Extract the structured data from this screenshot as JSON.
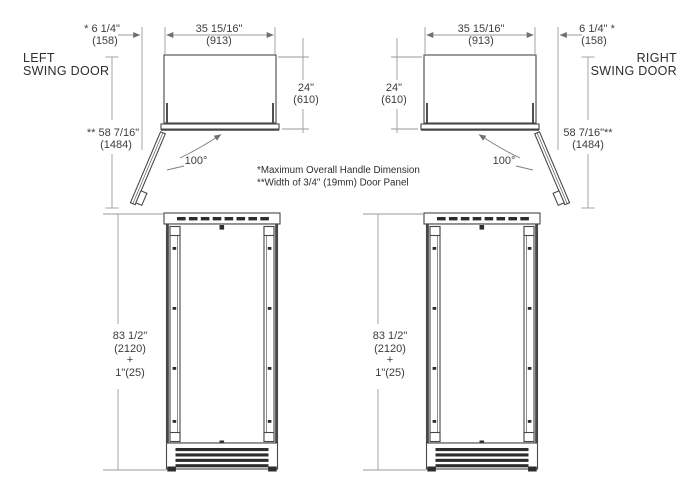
{
  "labels": {
    "left_door": [
      "LEFT",
      "SWING DOOR"
    ],
    "right_door": [
      "RIGHT",
      "SWING DOOR"
    ]
  },
  "notes": [
    "*Maximum Overall Handle Dimension",
    "**Width of 3/4\" (19mm) Door Panel"
  ],
  "left": {
    "handle_clearance_in": "* 6 1/4\"",
    "handle_clearance_mm": "(158)",
    "width_in": "35 15/16\"",
    "width_mm": "(913)",
    "depth_in": "24\"",
    "depth_mm": "(610)",
    "open_depth_in": "** 58 7/16\"",
    "open_depth_mm": "(1484)",
    "swing_angle": "100°",
    "height_in": "83 1/2\"",
    "height_mm": "(2120)",
    "height_plus": "+",
    "height_extra": "1\"(25)"
  },
  "right": {
    "handle_clearance_in": "6 1/4\" *",
    "handle_clearance_mm": "(158)",
    "width_in": "35 15/16\"",
    "width_mm": "(913)",
    "depth_in": "24\"",
    "depth_mm": "(610)",
    "open_depth_in": "58 7/16\"**",
    "open_depth_mm": "(1484)",
    "swing_angle": "100°",
    "height_in": "83 1/2\"",
    "height_mm": "(2120)",
    "height_plus": "+",
    "height_extra": "1\"(25)"
  }
}
